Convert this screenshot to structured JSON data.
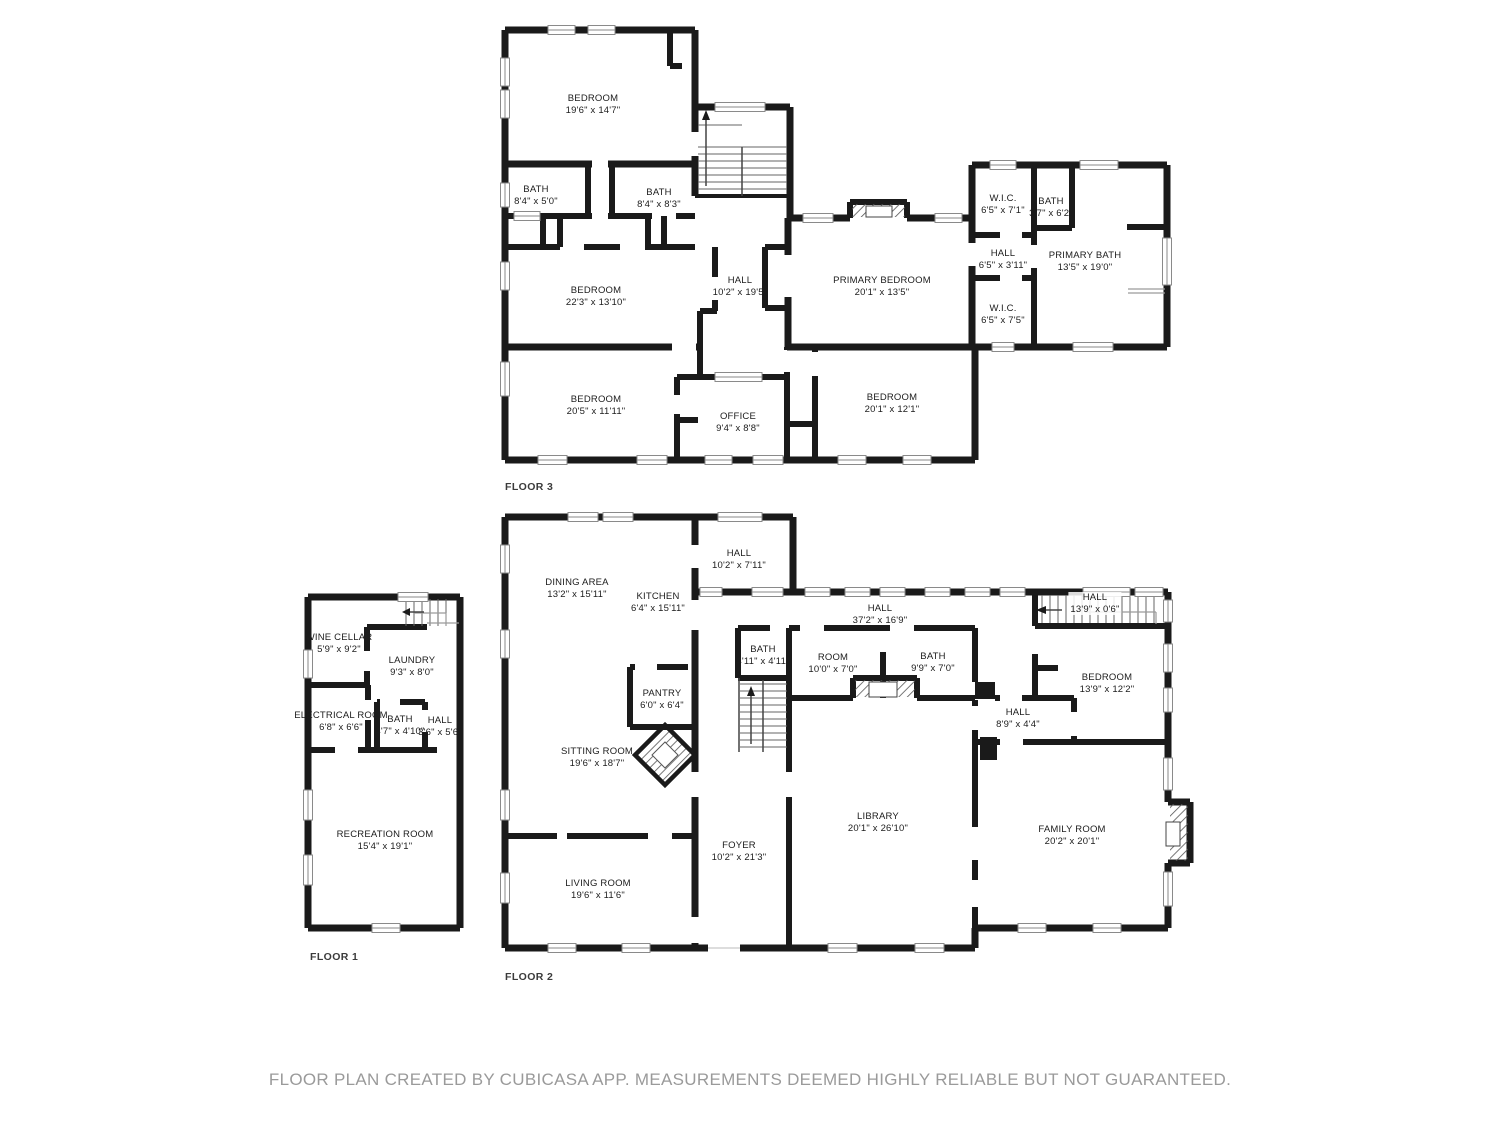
{
  "floors": [
    {
      "label": "FLOOR 3",
      "rooms": [
        {
          "name": "BEDROOM",
          "dims": "19'6\" x 14'7\""
        },
        {
          "name": "BATH",
          "dims": "8'4\" x 5'0\""
        },
        {
          "name": "BATH",
          "dims": "8'4\" x 8'3\""
        },
        {
          "name": "BEDROOM",
          "dims": "22'3\" x 13'10\""
        },
        {
          "name": "HALL",
          "dims": "10'2\" x 19'5\""
        },
        {
          "name": "PRIMARY BEDROOM",
          "dims": "20'1\" x 13'5\""
        },
        {
          "name": "W.I.C.",
          "dims": "6'5\" x 7'1\""
        },
        {
          "name": "BATH",
          "dims": "3'7\" x 6'2\""
        },
        {
          "name": "HALL",
          "dims": "6'5\" x 3'11\""
        },
        {
          "name": "W.I.C.",
          "dims": "6'5\" x 7'5\""
        },
        {
          "name": "PRIMARY BATH",
          "dims": "13'5\" x 19'0\""
        },
        {
          "name": "BEDROOM",
          "dims": "20'5\" x 11'11\""
        },
        {
          "name": "OFFICE",
          "dims": "9'4\" x 8'8\""
        },
        {
          "name": "BEDROOM",
          "dims": "20'1\" x 12'1\""
        }
      ]
    },
    {
      "label": "FLOOR 1",
      "rooms": [
        {
          "name": "WINE CELLAR",
          "dims": "5'9\" x 9'2\""
        },
        {
          "name": "LAUNDRY",
          "dims": "9'3\" x 8'0\""
        },
        {
          "name": "ELECTRICAL ROOM",
          "dims": "6'8\" x 6'6\""
        },
        {
          "name": "BATH",
          "dims": "4'7\" x 4'10\""
        },
        {
          "name": "HALL",
          "dims": "3'6\" x 5'6\""
        },
        {
          "name": "RECREATION ROOM",
          "dims": "15'4\" x 19'1\""
        }
      ]
    },
    {
      "label": "FLOOR 2",
      "rooms": [
        {
          "name": "HALL",
          "dims": "10'2\" x 7'11\""
        },
        {
          "name": "DINING AREA",
          "dims": "13'2\" x 15'11\""
        },
        {
          "name": "KITCHEN",
          "dims": "6'4\" x 15'11\""
        },
        {
          "name": "HALL",
          "dims": "37'2\" x 16'9\""
        },
        {
          "name": "HALL",
          "dims": "13'9\" x 0'6\""
        },
        {
          "name": "BATH",
          "dims": "4'11\" x 4'11\""
        },
        {
          "name": "ROOM",
          "dims": "10'0\" x 7'0\""
        },
        {
          "name": "BATH",
          "dims": "9'9\" x 7'0\""
        },
        {
          "name": "BEDROOM",
          "dims": "13'9\" x 12'2\""
        },
        {
          "name": "HALL",
          "dims": "8'9\" x 4'4\""
        },
        {
          "name": "PANTRY",
          "dims": "6'0\" x 6'4\""
        },
        {
          "name": "SITTING ROOM",
          "dims": "19'6\" x 18'7\""
        },
        {
          "name": "FOYER",
          "dims": "10'2\" x 21'3\""
        },
        {
          "name": "LIBRARY",
          "dims": "20'1\" x 26'10\""
        },
        {
          "name": "FAMILY ROOM",
          "dims": "20'2\" x 20'1\""
        },
        {
          "name": "LIVING ROOM",
          "dims": "19'6\" x 11'6\""
        }
      ]
    }
  ],
  "footer": {
    "disclaimer": "FLOOR PLAN CREATED BY CUBICASA APP. MEASUREMENTS DEEMED HIGHLY RELIABLE BUT NOT GUARANTEED."
  },
  "colors": {
    "wall": "#1a1a1a",
    "label": "#1c1c1c",
    "win": "#8a8a8a",
    "stair": "#666666",
    "floorlabel": "#3b3b3b",
    "disc": "#9a9a9a"
  }
}
